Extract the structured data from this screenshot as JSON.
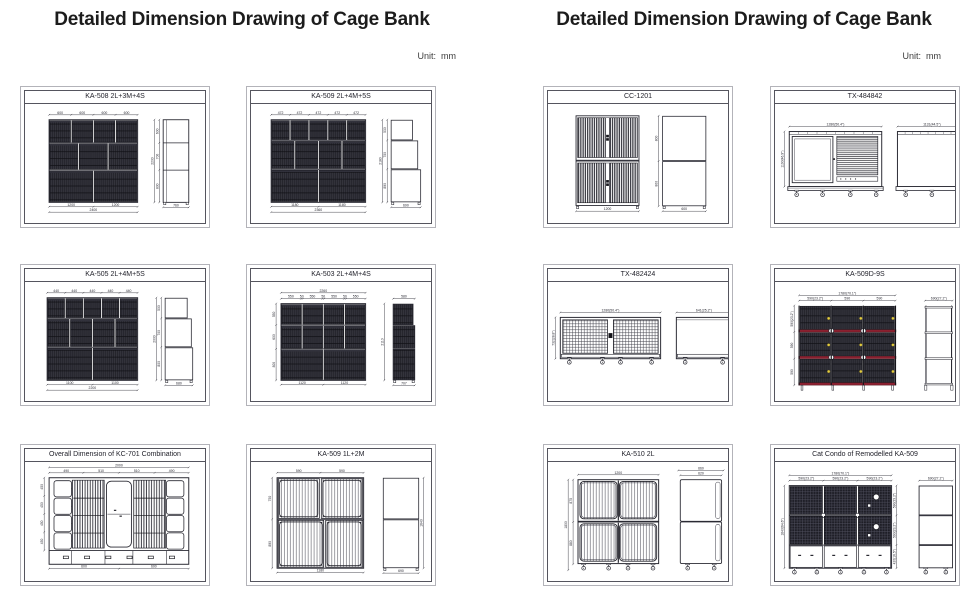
{
  "colors": {
    "line": "#2a2a33",
    "dim": "#34343d",
    "tray_red": "#8b2030",
    "latch_yellow": "#e4cd3f"
  },
  "pages": [
    {
      "title": "Detailed Dimension Drawing of Cage Bank",
      "unit": "Unit:  mm",
      "panels": [
        {
          "model": "KA-508 2L+3M+4S",
          "drawing": {
            "kind": "bank",
            "front": [
              24,
              16,
              90,
              84
            ],
            "rows": [
              {
                "c": 4,
                "h": 0.28
              },
              {
                "c": 3,
                "h": 0.33
              },
              {
                "c": 2,
                "h": 0.39
              }
            ],
            "top_dims": [
              "600",
              "600",
              "600",
              "600"
            ],
            "bottom_dims": [
              "1200",
              "1200"
            ],
            "bottom_total": "2400",
            "side": {
              "x": 140,
              "w": 26,
              "style": "flat",
              "segs": [
                {
                  "h": 0.28,
                  "l": "600"
                },
                {
                  "h": 0.33,
                  "l": "700"
                },
                {
                  "h": 0.39,
                  "l": "800"
                }
              ],
              "total": "2200",
              "depth": "760"
            }
          }
        },
        {
          "model": "KA-509 2L+4M+5S",
          "drawing": {
            "kind": "bank",
            "front": [
              20,
              16,
              96,
              84
            ],
            "rows": [
              {
                "c": 5,
                "h": 0.25
              },
              {
                "c": 4,
                "h": 0.35
              },
              {
                "c": 2,
                "h": 0.4
              }
            ],
            "top_dims": [
              "472",
              "472",
              "472",
              "472",
              "472"
            ],
            "bottom_dims": [
              "1180",
              "1180"
            ],
            "bottom_total": "2360",
            "side": {
              "x": 142,
              "w": 30,
              "style": "stagger",
              "widths": [
                0.72,
                0.9,
                1
              ],
              "segs": [
                {
                  "h": 0.25,
                  "l": "530"
                },
                {
                  "h": 0.35,
                  "l": "750"
                },
                {
                  "h": 0.4,
                  "l": "890"
                }
              ],
              "total": "2180",
              "depth": "690"
            }
          }
        },
        {
          "model": "KA-505 2L+4M+5S",
          "drawing": {
            "kind": "bank",
            "front": [
              22,
              16,
              92,
              84
            ],
            "rows": [
              {
                "c": 5,
                "h": 0.25
              },
              {
                "c": 4,
                "h": 0.35
              },
              {
                "c": 2,
                "h": 0.4
              }
            ],
            "top_dims": [
              "440",
              "440",
              "440",
              "440",
              "440"
            ],
            "bottom_dims": [
              "1100",
              "1100"
            ],
            "bottom_total": "2200",
            "side": {
              "x": 142,
              "w": 28,
              "style": "stagger",
              "widths": [
                0.8,
                0.95,
                1
              ],
              "segs": [
                {
                  "h": 0.25,
                  "l": "500"
                },
                {
                  "h": 0.35,
                  "l": "700"
                },
                {
                  "h": 0.4,
                  "l": "800"
                }
              ],
              "total": "2000",
              "depth": "680"
            }
          }
        },
        {
          "model": "KA-503 2L+4M+4S",
          "drawing": {
            "kind": "bank",
            "front": [
              30,
              22,
              86,
              78
            ],
            "top_total": "2260",
            "top_dims": [
              "550",
              "50",
              "550",
              "50",
              "550",
              "50",
              "550"
            ],
            "rows": [
              {
                "c": 4,
                "h": 0.28
              },
              {
                "c": 4,
                "h": 0.31
              },
              {
                "c": 2,
                "h": 0.41
              }
            ],
            "left_dims": [
              "550",
              "600",
              "800"
            ],
            "bottom_dims": [
              "1120",
              "1120"
            ],
            "side": {
              "x": 144,
              "w": 22,
              "style": "hatchstack",
              "widths": [
                0.92,
                1,
                1
              ],
              "segs": [
                {
                  "h": 0.28,
                  "l": ""
                },
                {
                  "h": 0.31,
                  "l": ""
                },
                {
                  "h": 0.41,
                  "l": ""
                }
              ],
              "top": "580",
              "total": "2110",
              "depth": "707"
            }
          }
        },
        {
          "model": "Overall Dimension of KC-701 Combination",
          "drawing": {
            "kind": "topview",
            "frame": [
              24,
              16,
              142,
              88
            ],
            "top_total": "2000",
            "top_dims": [
              "490",
              "510",
              "510",
              "490"
            ],
            "left_dims": [
              "450",
              "450",
              "450",
              "450"
            ],
            "bottom_dims": [
              "600",
              "600"
            ]
          }
        },
        {
          "model": "KA-509 1L+2M",
          "drawing": {
            "kind": "wire",
            "front": [
              26,
              16,
              88,
              92
            ],
            "rows": [
              {
                "c": 2,
                "h": 0.46
              },
              {
                "c": 2,
                "h": 0.54,
                "w": [
                  0.55,
                  0.45
                ]
              }
            ],
            "top_dims": [
              "590",
              "590"
            ],
            "left_dims": [
              "750",
              "890"
            ],
            "bottom_total": "1180",
            "side": {
              "x": 134,
              "w": 36,
              "style": "stagger",
              "widths": [
                1,
                1
              ],
              "segs": [
                {
                  "h": 0.46,
                  "l": ""
                },
                {
                  "h": 0.54,
                  "l": ""
                }
              ],
              "right_total": "1640",
              "depth": "690"
            }
          }
        }
      ]
    },
    {
      "title": "Detailed Dimension Drawing of Cage Bank",
      "unit": "Unit:  mm",
      "panels": [
        {
          "model": "CC-1201",
          "drawing": {
            "kind": "stack2",
            "front": [
              28,
              12,
              64,
              92
            ],
            "bottom_total": "1200",
            "side": {
              "x": 116,
              "w": 44,
              "style": "stagger",
              "widths": [
                1,
                1
              ],
              "segs": [
                {
                  "h": 0.5,
                  "l": "800"
                },
                {
                  "h": 0.5,
                  "l": "800"
                }
              ],
              "depth": "600"
            }
          }
        },
        {
          "model": "TX-484842",
          "drawing": {
            "kind": "cabinet",
            "front": [
              14,
              28,
              94,
              66
            ],
            "front_top": "1280(50.4\")",
            "front_left": "1190(46.9\")",
            "side": [
              124,
              28,
              70,
              66
            ],
            "side_top": "1131(44.5\")"
          }
        },
        {
          "model": "TX-482424",
          "drawing": {
            "kind": "meshbox",
            "front": [
              12,
              36,
              102,
              50
            ],
            "front_top": "1280(50.4\")",
            "front_left": "732(28.8\")",
            "side": [
              130,
              36,
              56,
              50
            ],
            "side_top": "641(25.2\")"
          }
        },
        {
          "model": "KA-509D-9S",
          "drawing": {
            "kind": "rack9",
            "front": [
              24,
              24,
              98,
              86
            ],
            "top_total": "1780(70.1\")",
            "top_dims": [
              "590(23.2\")",
              "590",
              "590"
            ],
            "left_dims": [
              "590(23.2\")",
              "590",
              "590"
            ],
            "side": [
              152,
              24,
              28,
              86
            ],
            "side_top": "690(27.2\")"
          }
        },
        {
          "model": "KA-510 2L",
          "drawing": {
            "kind": "big2",
            "front": [
              30,
              18,
              82,
              94
            ],
            "top": "1200",
            "left_total": "1800",
            "left_segs": [
              "875",
              "880"
            ],
            "side": [
              134,
              18,
              42,
              94
            ],
            "side_top1": "660",
            "side_top2": "620"
          }
        },
        {
          "model": "Cat Condo of Remodelled KA-509",
          "drawing": {
            "kind": "condo",
            "front": [
              14,
              24,
              104,
              84
            ],
            "top_total": "1780(70.1\")",
            "top_dims": [
              "590(23.2\")",
              "590(23.2\")",
              "590(23.2\")"
            ],
            "right_dims": [
              "590(23.2\")",
              "590(23.2\")",
              "420(16.5\")"
            ],
            "left_total": "1640(64.6\")",
            "rows_h": [
              0.36,
              0.36,
              0.28
            ],
            "side": [
              146,
              24,
              34,
              84
            ],
            "side_top": "690(27.2\")"
          }
        }
      ]
    }
  ]
}
